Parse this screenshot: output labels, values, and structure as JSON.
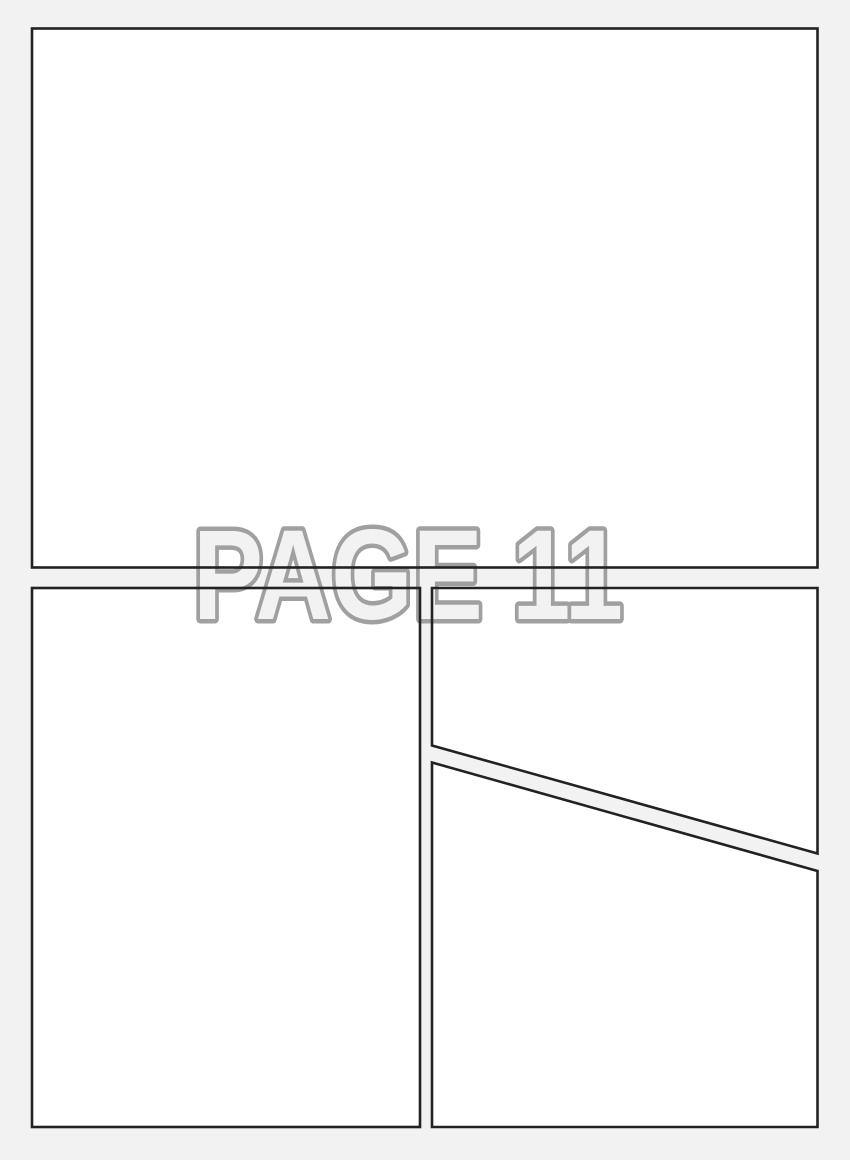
{
  "page": {
    "label": "PAGE 11",
    "panel_count": 4
  },
  "panels": [
    {
      "id": "panel-1",
      "position": "top full-width",
      "content": ""
    },
    {
      "id": "panel-2",
      "position": "bottom-left tall",
      "content": ""
    },
    {
      "id": "panel-3",
      "position": "right upper (diagonal bottom edge)",
      "content": ""
    },
    {
      "id": "panel-4",
      "position": "right lower (diagonal top edge)",
      "content": ""
    }
  ],
  "colors": {
    "background": "#f2f2f2",
    "panel_fill": "#ffffff",
    "panel_border": "#222222",
    "watermark_fill": "#f2f2f2",
    "watermark_outline": "#a0a0a0"
  }
}
